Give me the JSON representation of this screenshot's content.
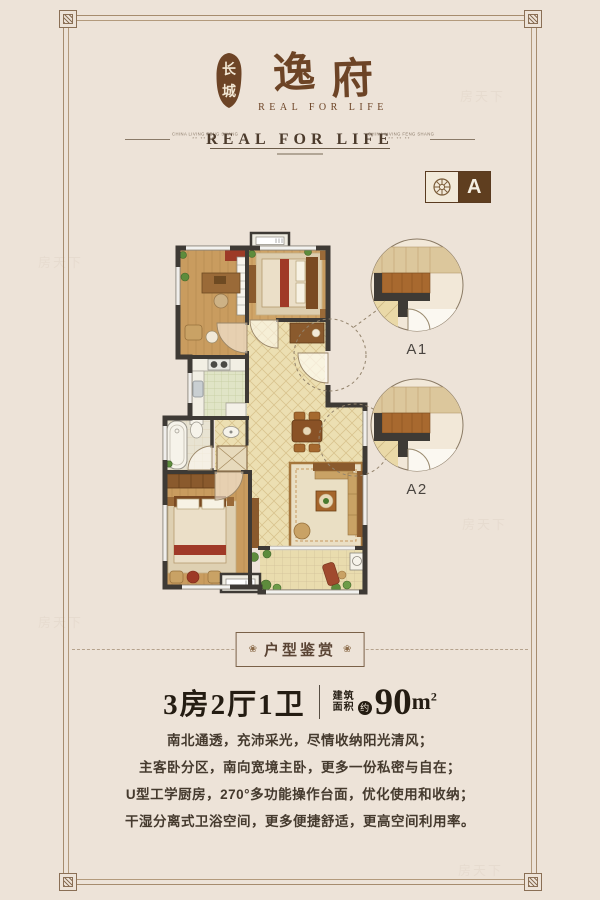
{
  "page": {
    "background": "#ede3d8",
    "accent": "#6d4426",
    "ink": "#241c12"
  },
  "logo": {
    "seal_chars": [
      "长",
      "城"
    ],
    "brand_chars": [
      "逸",
      "府"
    ],
    "tagline": "REAL FOR LIFE"
  },
  "header_band": {
    "title": "REAL FOR LIFE",
    "side_text": "CHINA LIVING FENG SHANG",
    "side_subtext": "** ** **"
  },
  "unit_badge": {
    "label": "A",
    "icon": "rosette-icon"
  },
  "floor_plan": {
    "detail_labels": [
      "A1",
      "A2"
    ]
  },
  "section_banner": {
    "title": "户型鉴赏",
    "rosette_glyph": "❀"
  },
  "unit_summary": {
    "layout": "3房2厅1卫",
    "area_label_top": "建筑",
    "area_label_bottom": "面积",
    "area_approx": "约",
    "area_value": "90",
    "area_unit_base": "m",
    "area_unit_sup": "2"
  },
  "description": {
    "lines": [
      "南北通透，充沛采光，尽情收纳阳光清风；",
      "主客卧分区，南向宽境主卧，更多一份私密与自在；",
      "U型工学厨房，270°多功能操作台面，优化使用和收纳；",
      "干湿分离式卫浴空间，更多便捷舒适，更高空间利用率。"
    ]
  },
  "watermark": {
    "text": "房天下"
  }
}
